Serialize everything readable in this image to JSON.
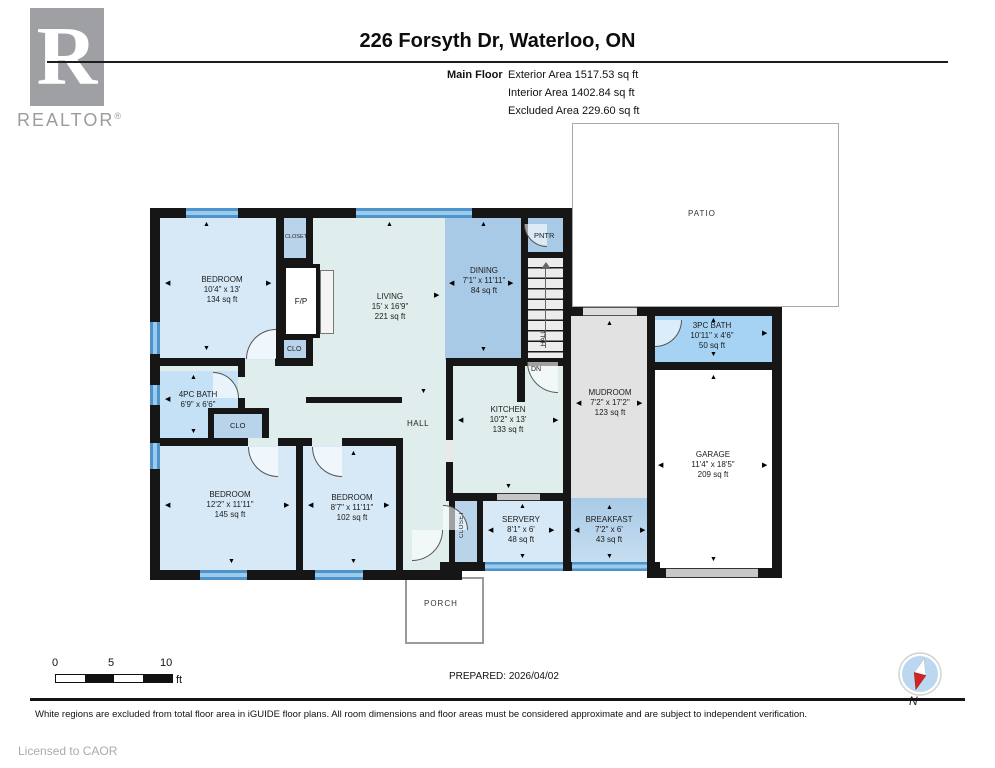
{
  "header": {
    "title": "226 Forsyth Dr, Waterloo, ON",
    "floor_label": "Main Floor",
    "area_exterior": "Exterior Area 1517.53 sq ft",
    "area_interior": "Interior Area 1402.84 sq ft",
    "area_excluded": "Excluded Area 229.60 sq ft"
  },
  "logo": {
    "letter": "R",
    "text": "REALTOR",
    "reg": "®"
  },
  "rooms": [
    {
      "name": "BEDROOM",
      "dims": "10'4\" x 13'",
      "area": "134 sq ft"
    },
    {
      "name": "LIVING",
      "dims": "15' x 16'9\"",
      "area": "221 sq ft"
    },
    {
      "name": "DINING",
      "dims": "7'1\" x 11'11\"",
      "area": "84 sq ft"
    },
    {
      "name": "KITCHEN",
      "dims": "10'2\" x 13'",
      "area": "133 sq ft"
    },
    {
      "name": "MUDROOM",
      "dims": "7'2\" x 17'2\"",
      "area": "123 sq ft"
    },
    {
      "name": "3PC BATH",
      "dims": "10'11\" x 4'6\"",
      "area": "50 sq ft"
    },
    {
      "name": "GARAGE",
      "dims": "11'4\" x 18'5\"",
      "area": "209 sq ft"
    },
    {
      "name": "4PC BATH",
      "dims": "6'9\" x 6'6\"",
      "area": ""
    },
    {
      "name": "BEDROOM",
      "dims": "12'2\" x 11'11\"",
      "area": "145 sq ft"
    },
    {
      "name": "BEDROOM",
      "dims": "8'7\" x 11'11\"",
      "area": "102 sq ft"
    },
    {
      "name": "SERVERY",
      "dims": "8'1\" x 6'",
      "area": "48 sq ft"
    },
    {
      "name": "BREAKFAST",
      "dims": "7'2\" x 6'",
      "area": "43 sq ft"
    }
  ],
  "labels": {
    "closet_top": "CLOSET",
    "fp": "F/P",
    "clo_top": "CLO",
    "clo_bath": "CLO",
    "pntr": "PNTR",
    "hall": "HALL",
    "hall_stairs": "HALL",
    "dn": "DN",
    "closet_vertical": "CLOSET",
    "porch": "PORCH",
    "patio": "PATIO"
  },
  "scale": {
    "t0": "0",
    "t5": "5",
    "t10": "10",
    "unit": "ft"
  },
  "footer": {
    "prepared": "PREPARED: 2026/04/02",
    "disclaimer": "White regions are excluded from total floor area in iGUIDE floor plans. All room dimensions and floor areas must be considered approximate and are subject to independent verification.",
    "licensed": "Licensed to CAOR",
    "compass_n": "N"
  },
  "colors": {
    "wall": "#161616",
    "pale_interior": "#DFEEEC",
    "bedroom_blue": "#D7E9F7",
    "medium_blue": "#A9CAE6",
    "closet_blue": "#B9D3EB",
    "bath4_blue": "#C5E1F5",
    "bath3_blue": "#A6D3F3",
    "mud_gray": "#E2E2E2",
    "window_blue": "#4D94CC"
  }
}
